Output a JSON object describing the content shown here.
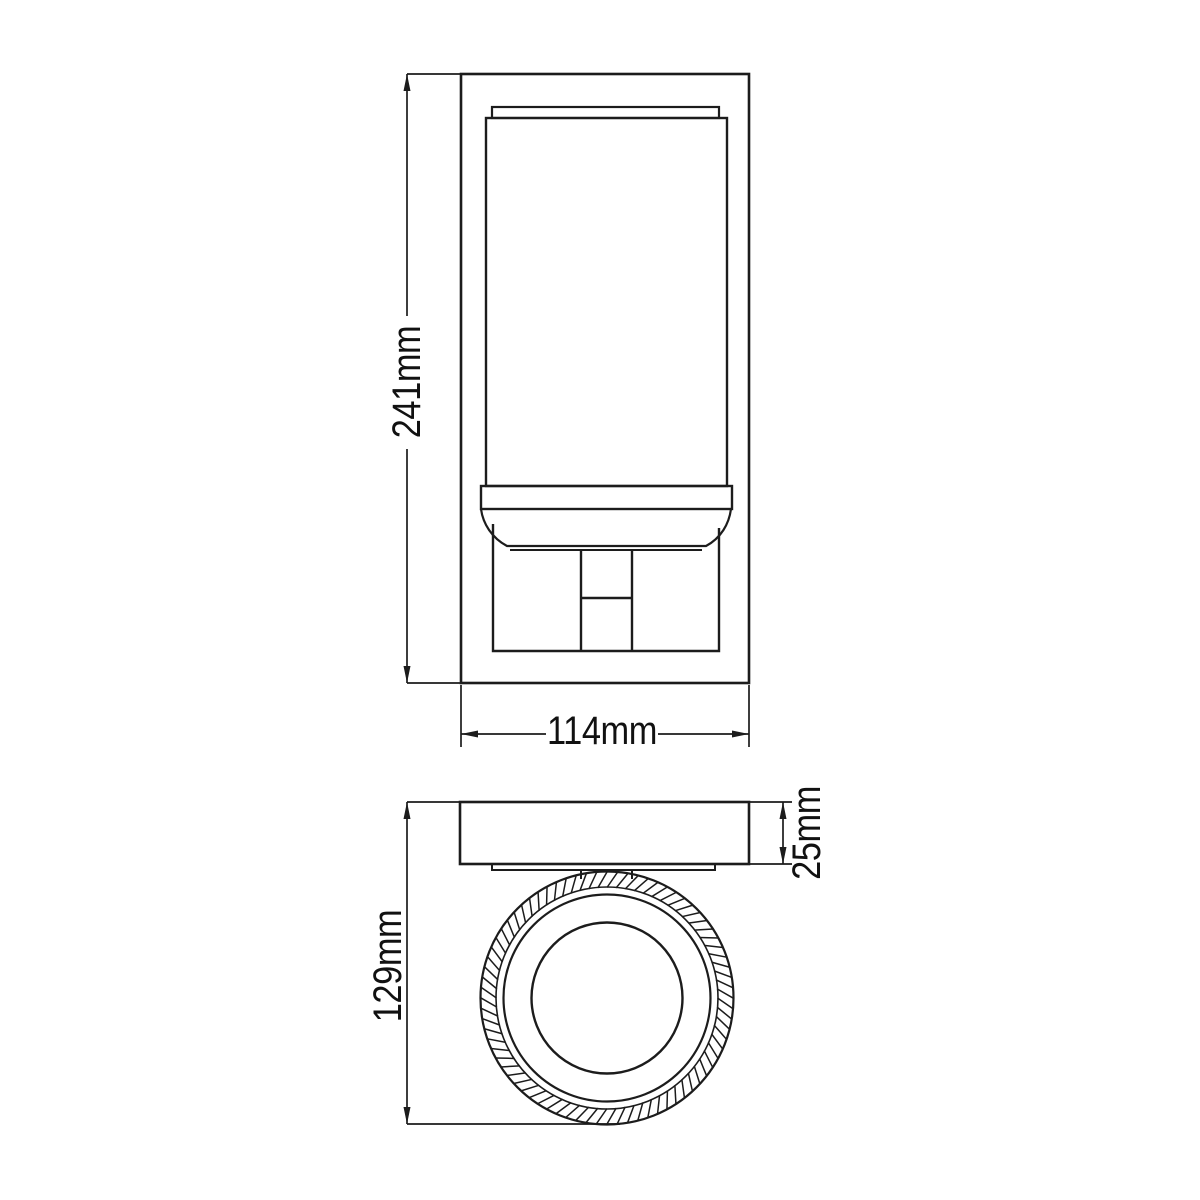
{
  "drawing": {
    "type": "technical-dimension-drawing",
    "views": {
      "front": "front elevation of wall fixture with cylindrical shade and mounting bracket",
      "top": "top plan view with wall plate and knurled circular holder"
    },
    "line_color": "#1c1c1c",
    "text_color": "#111111",
    "background": "#ffffff"
  },
  "dimensions": {
    "height": {
      "label": "241mm",
      "orientation": "vertical",
      "view": "front"
    },
    "width": {
      "label": "114mm",
      "orientation": "horizontal",
      "view": "front"
    },
    "depth": {
      "label": "129mm",
      "orientation": "vertical",
      "view": "top"
    },
    "plate_thickness": {
      "label": "25mm",
      "orientation": "vertical",
      "view": "top"
    }
  }
}
